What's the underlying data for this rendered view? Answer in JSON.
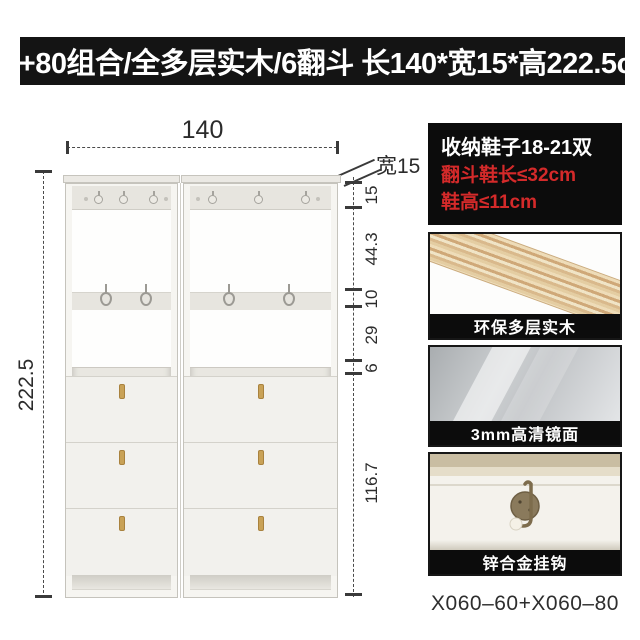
{
  "banner": {
    "title": "60+80组合/全多层实木/6翻斗 长140*宽15*高222.5cm"
  },
  "diagram": {
    "width_label": "140",
    "depth_label": "宽15",
    "height_label": "222.5",
    "right_dims": [
      "15",
      "44.3",
      "10",
      "29",
      "6",
      "116.7"
    ]
  },
  "panel": {
    "stat": {
      "line1": "收纳鞋子18-21双",
      "line2": "翻斗鞋长≤32cm",
      "line3": "鞋高≤11cm"
    },
    "cards": [
      {
        "label": "环保多层实木"
      },
      {
        "label": "3mm高清镜面"
      },
      {
        "label": "锌合金挂钩"
      }
    ],
    "model_code": "X060–60+X060–80"
  },
  "colors": {
    "banner_bg": "#141414",
    "alert_red": "#d42a2a",
    "handle_gold": "#c9a257",
    "cabinet_body": "#f6f5f1"
  }
}
